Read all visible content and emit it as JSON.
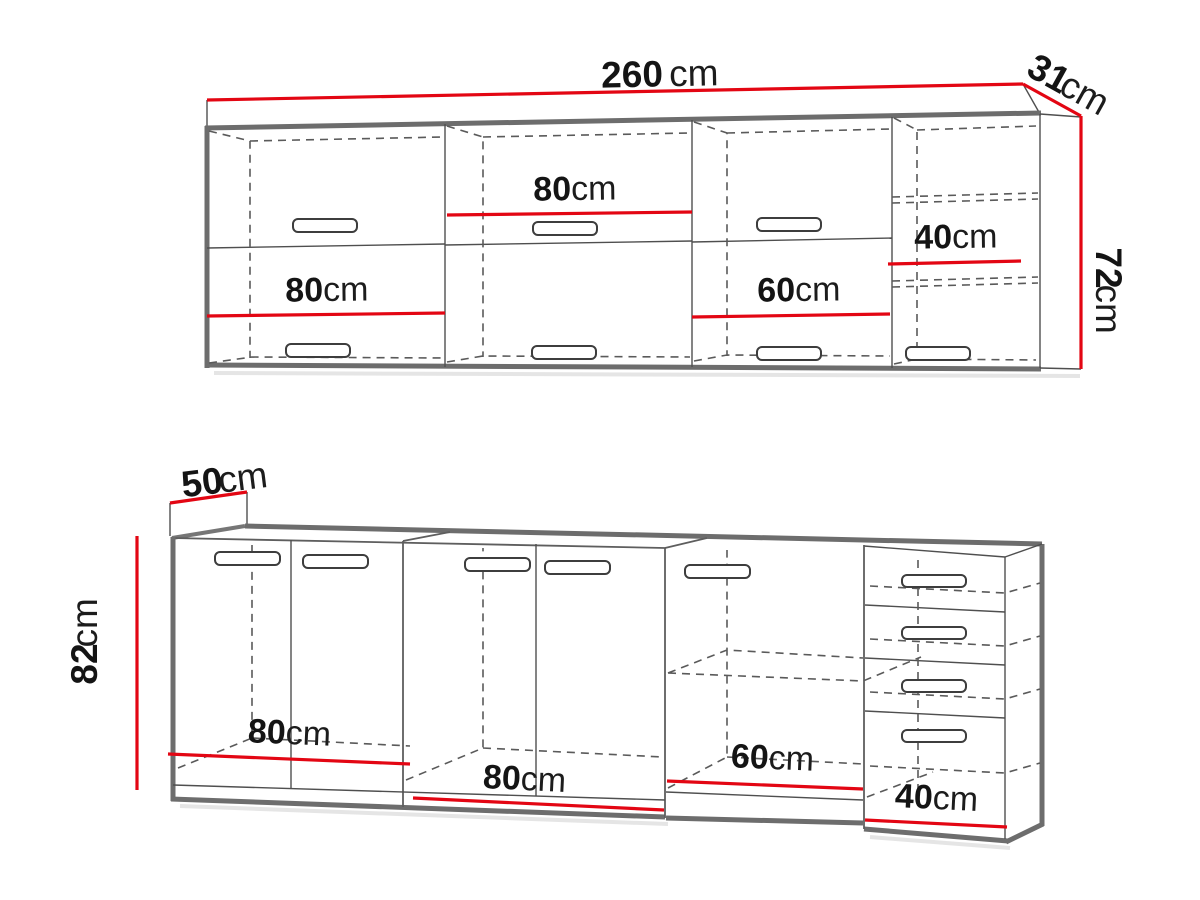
{
  "drawing": {
    "type": "kitchen-cabinet-dimension-diagram",
    "style": {
      "dimension_color": "#e30613",
      "outline_color": "#6d6d6d",
      "sketch_line_color": "#4f4f4f",
      "dashed_line_color": "#5a5a5a",
      "background": "#ffffff"
    }
  },
  "wall_unit": {
    "width": {
      "value": "260",
      "unit": "cm"
    },
    "depth": {
      "value": "31",
      "unit": "cm"
    },
    "height": {
      "value": "72",
      "unit": "cm"
    },
    "sections": [
      {
        "value": "80",
        "unit": "cm"
      },
      {
        "value": "80",
        "unit": "cm"
      },
      {
        "value": "60",
        "unit": "cm"
      },
      {
        "value": "40",
        "unit": "cm"
      }
    ]
  },
  "base_unit": {
    "depth": {
      "value": "50",
      "unit": "cm"
    },
    "height": {
      "value": "82",
      "unit": "cm"
    },
    "sections": [
      {
        "value": "80",
        "unit": "cm"
      },
      {
        "value": "80",
        "unit": "cm"
      },
      {
        "value": "60",
        "unit": "cm"
      },
      {
        "value": "40",
        "unit": "cm"
      }
    ]
  }
}
